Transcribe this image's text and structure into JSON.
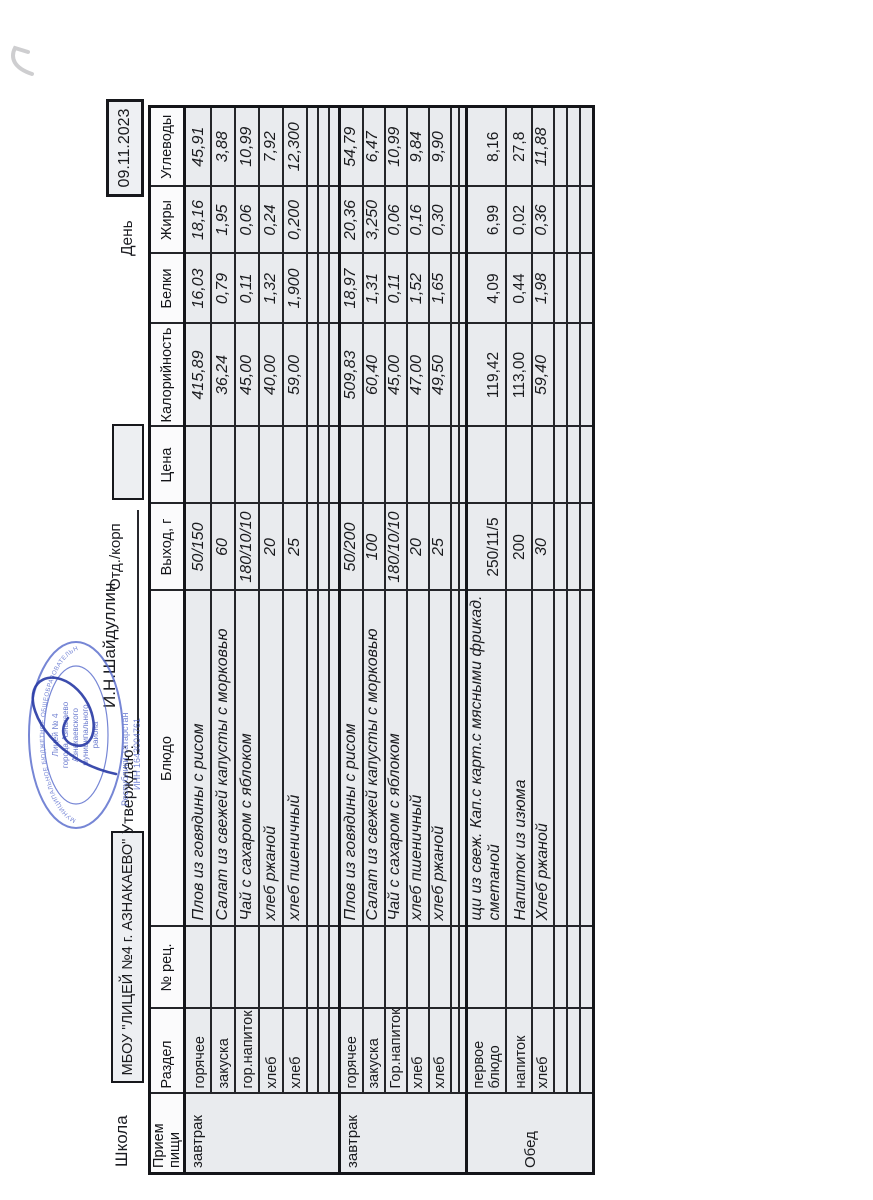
{
  "header": {
    "school_label": "Школа",
    "school_name": "МБОУ \"ЛИЦЕЙ №4 г. АЗНАКАЕВО\"",
    "approve_label": "Утверждаю:",
    "approver_name": "И.Н.Шайдуллин",
    "dept_label": "Отд./корп",
    "day_label": "День",
    "date": "09.11.2023"
  },
  "stamp": {
    "outer_top": "МУНИЦИПАЛЬНОЕ БЮДЖЕТНОЕ ОБЩЕОБРАЗОВАТЕЛЬНОЕ УЧРЕЖДЕНИЕ",
    "line1": "Лицей № 4",
    "line2": "города Азнакаево",
    "line3": "Азнакаевского",
    "line4": "муниципального",
    "line5": "района",
    "outer_bottom1": "Республики Татарстан",
    "outer_bottom2": "ИНН 1643004761",
    "ink_color": "#5468cb"
  },
  "table": {
    "columns": [
      "Прием пищи",
      "Раздел",
      "№ рец.",
      "Блюдо",
      "Выход, г",
      "Цена",
      "Калорийность",
      "Белки",
      "Жиры",
      "Углеводы"
    ],
    "sections": [
      {
        "meal": "завтрак",
        "empty_rows": 3,
        "rows": [
          {
            "razdel": "горячее",
            "dish": "Плов из говядины с рисом",
            "out": "50/150",
            "kcal": "415,89",
            "protein": "16,03",
            "fat": "18,16",
            "carbs": "45,91",
            "upright": false
          },
          {
            "razdel": "закуска",
            "dish": "Салат из свежей капусты с морковью",
            "out": "60",
            "kcal": "36,24",
            "protein": "0,79",
            "fat": "1,95",
            "carbs": "3,88",
            "upright": false
          },
          {
            "razdel": "гор.напиток",
            "dish": "Чай с сахаром с яблоком",
            "out": "180/10/10",
            "kcal": "45,00",
            "protein": "0,11",
            "fat": "0,06",
            "carbs": "10,99",
            "upright": false
          },
          {
            "razdel": "хлеб",
            "dish": "хлеб ржаной",
            "out": "20",
            "kcal": "40,00",
            "protein": "1,32",
            "fat": "0,24",
            "carbs": "7,92",
            "upright": false
          },
          {
            "razdel": "хлеб",
            "dish": "хлеб пшеничный",
            "out": "25",
            "kcal": "59,00",
            "protein": "1,900",
            "fat": "0,200",
            "carbs": "12,300",
            "upright": false
          }
        ]
      },
      {
        "meal": "завтрак",
        "empty_rows": 2,
        "rows": [
          {
            "razdel": "горячее",
            "dish": "Плов из говядины с рисом",
            "out": "50/200",
            "kcal": "509,83",
            "protein": "18,97",
            "fat": "20,36",
            "carbs": "54,79",
            "upright": false
          },
          {
            "razdel": "закуска",
            "dish": "Салат из свежей капусты с морковью",
            "out": "100",
            "kcal": "60,40",
            "protein": "1,31",
            "fat": "3,250",
            "carbs": "6,47",
            "upright": false
          },
          {
            "razdel": "Гор.напиток",
            "dish": "Чай с сахаром с яблоком",
            "out": "180/10/10",
            "kcal": "45,00",
            "protein": "0,11",
            "fat": "0,06",
            "carbs": "10,99",
            "upright": false
          },
          {
            "razdel": "хлеб",
            "dish": "хлеб пшеничный",
            "out": "20",
            "kcal": "47,00",
            "protein": "1,52",
            "fat": "0,16",
            "carbs": "9,84",
            "upright": false
          },
          {
            "razdel": "хлеб",
            "dish": "хлеб ржаной",
            "out": "25",
            "kcal": "49,50",
            "protein": "1,65",
            "fat": "0,30",
            "carbs": "9,90",
            "upright": false
          }
        ]
      },
      {
        "meal": "Обед",
        "empty_rows": 3,
        "rows": [
          {
            "razdel": "первое блюдо",
            "dish": "щи из свеж. Кап.с карт.с мясными фрикад. сметаной",
            "out": "250/11/5",
            "kcal": "119,42",
            "protein": "4,09",
            "fat": "6,99",
            "carbs": "8,16",
            "upright": true
          },
          {
            "razdel": "напиток",
            "dish": "Напиток из изюма",
            "out": "200",
            "kcal": "113,00",
            "protein": "0,44",
            "fat": "0,02",
            "carbs": "27,8",
            "upright": true
          },
          {
            "razdel": "хлеб",
            "dish": "Хлеб ржаной",
            "out": "30",
            "kcal": "59,40",
            "protein": "1,98",
            "fat": "0,36",
            "carbs": "11,88",
            "upright": false
          }
        ]
      }
    ]
  }
}
